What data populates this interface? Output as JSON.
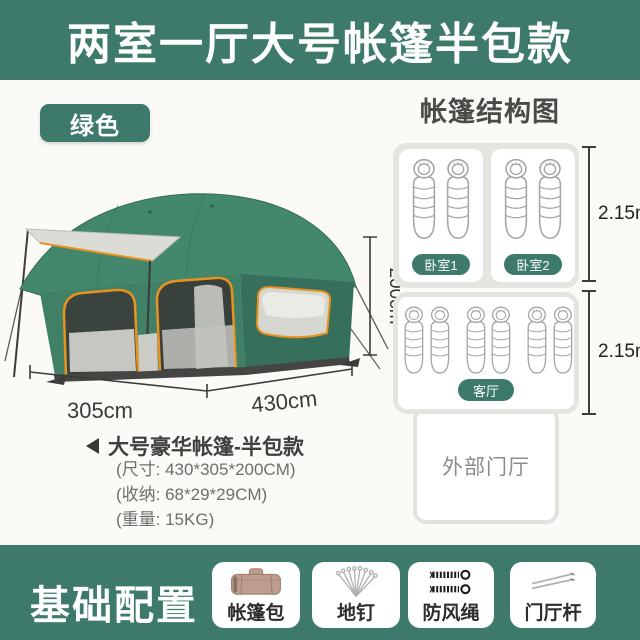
{
  "colors": {
    "accent": "#3d7a6c",
    "tent_green": "#3f8066",
    "trim_orange": "#e8921f",
    "page_bg": "#fbfaf7"
  },
  "header": {
    "title": "两室一厅大号帐篷半包款"
  },
  "color_badge": {
    "label": "绿色"
  },
  "structure_diagram": {
    "title": "帐篷结构图",
    "bedroom1_label": "卧室1",
    "bedroom2_label": "卧室2",
    "living_label": "客厅",
    "hall_label": "外部门厅",
    "bedroom_depth": "2.15m",
    "living_depth": "2.15m",
    "icons": [
      "sleeping-bag-icon"
    ]
  },
  "tent_dimensions": {
    "height": "200cm",
    "width": "305cm",
    "length": "430cm"
  },
  "specs": {
    "title": "大号豪华帐篷-半包款",
    "size_line": "(尺寸: 430*305*200CM)",
    "storage_line": "(收纳: 68*29*29CM)",
    "weight_line": "(重量: 15KG)"
  },
  "base_config": {
    "title": "基础配置",
    "items": [
      {
        "label": "帐篷包",
        "icon": "tent-bag-icon"
      },
      {
        "label": "地钉",
        "icon": "ground-stakes-icon"
      },
      {
        "label": "防风绳",
        "icon": "wind-rope-icon"
      },
      {
        "label": "门厅杆",
        "icon": "hall-pole-icon"
      }
    ]
  }
}
